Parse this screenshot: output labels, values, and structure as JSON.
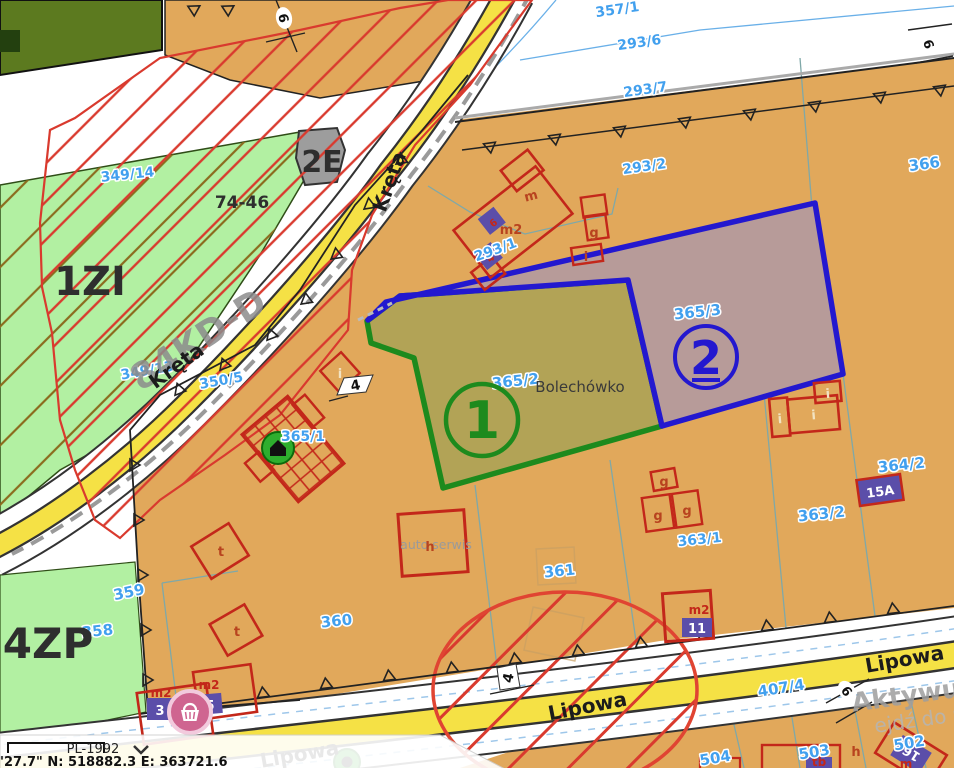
{
  "colors": {
    "base_parcel": "#e1a85b",
    "light_green_zone": "#b2f0a2",
    "dark_green_zone": "#5c7a1f",
    "selection1_stroke": "#1d8a1d",
    "selection1_fill": "#b2a356",
    "selection2_stroke": "#2318cf",
    "selection2_fill": "#b79b99",
    "parcel_label_blue": "#42a0ee",
    "hatch_red": "#d93a2e",
    "hatch_brown": "#8b6b1e",
    "road_yellow": "#f5e145",
    "building_red": "#c3271a",
    "address_purple": "#5b4ea9"
  },
  "place": "Bolechówko",
  "streets": {
    "kreta": "Kręta",
    "lipowa": "Lipowa"
  },
  "zones": {
    "zi": "1ZI",
    "e2": "2E",
    "zp": "4ZP",
    "forest": "74-46",
    "road_class": "84KD-D"
  },
  "selection": {
    "one": {
      "num": "1",
      "parcel": "365/2"
    },
    "two": {
      "num": "2",
      "parcel": "365/3"
    }
  },
  "parcels": {
    "357_1": "357/1",
    "293_6": "293/6",
    "293_7": "293/7",
    "293_2": "293/2",
    "366": "366",
    "349_14": "349/14",
    "349_13": "349/13",
    "350_5": "350/5",
    "293_1": "293/1",
    "365_1": "365/1",
    "365_2": "365/2",
    "365_3": "365/3",
    "364_2": "364/2",
    "363_2": "363/2",
    "363_1": "363/1",
    "361": "361",
    "360": "360",
    "359": "359",
    "358": "358",
    "407_4": "407/4",
    "504": "504",
    "503": "503",
    "502": "502"
  },
  "buildings": {
    "m": "m",
    "m2": "m2",
    "g": "g",
    "i": "i",
    "t": "t",
    "h": "h",
    "tb": "tb",
    "auto_serwis": "auto serwis",
    "num6": "6",
    "num4": "4"
  },
  "addresses": {
    "a15": "15A",
    "a11": "11",
    "a3": "3",
    "a5": "5",
    "a16": "16"
  },
  "road_marks": {
    "w6": "6",
    "w4": "4"
  },
  "watermark": {
    "line1": "Aktywuj",
    "line2": "ejdź do u"
  },
  "statusbar": {
    "crs": "PL-1992",
    "coords": "'27.7\"  N: 518882.3  E: 363721.6"
  }
}
